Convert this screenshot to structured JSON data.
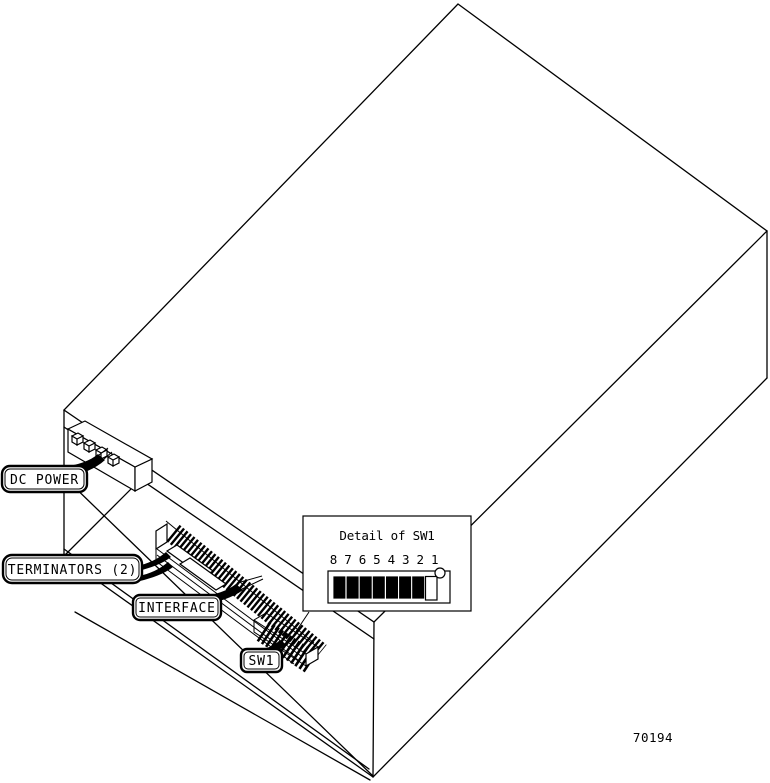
{
  "figure": {
    "number": "70194"
  },
  "callouts": [
    {
      "id": "dc-power",
      "label": "DC POWER"
    },
    {
      "id": "terminators",
      "label": "TERMINATORS (2)"
    },
    {
      "id": "interface",
      "label": "INTERFACE"
    },
    {
      "id": "sw1",
      "label": "SW1"
    }
  ],
  "detail_inset": {
    "title": "Detail of SW1",
    "position_labels": "8 7 6 5 4 3 2 1",
    "switches": [
      {
        "position": "8",
        "state": "on"
      },
      {
        "position": "7",
        "state": "on"
      },
      {
        "position": "6",
        "state": "on"
      },
      {
        "position": "5",
        "state": "on"
      },
      {
        "position": "4",
        "state": "on"
      },
      {
        "position": "3",
        "state": "on"
      },
      {
        "position": "2",
        "state": "on"
      },
      {
        "position": "1",
        "state": "off"
      }
    ],
    "colors": {
      "switch_on": "#000000",
      "switch_off": "#ffffff",
      "line": "#000000",
      "background": "#ffffff"
    }
  }
}
